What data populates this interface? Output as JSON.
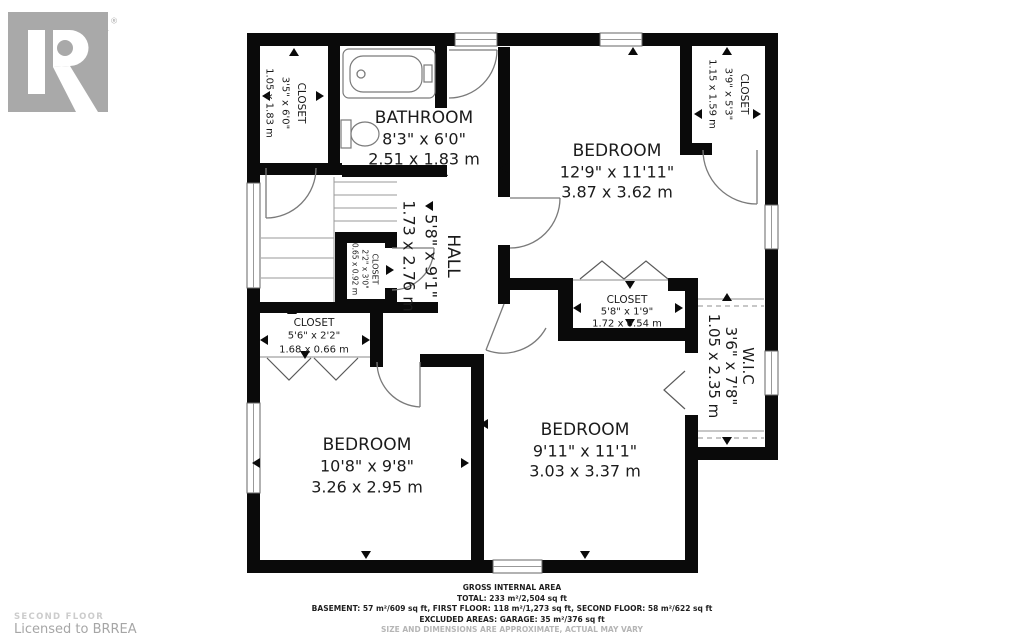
{
  "branding": {
    "logo_letter": "R",
    "logo_text": "REALTOR",
    "registered_mark": "®"
  },
  "credits": {
    "floor_label": "SECOND FLOOR",
    "license": "Licensed to BRREA"
  },
  "rooms": {
    "bathroom": {
      "name": "BATHROOM",
      "imperial": "8'3\" x 6'0\"",
      "metric": "2.51 x 1.83 m"
    },
    "bedroom_tr": {
      "name": "BEDROOM",
      "imperial": "12'9\" x 11'11\"",
      "metric": "3.87 x 3.62 m"
    },
    "hall": {
      "name": "HALL",
      "imperial": "5'8\" x 9'1\"",
      "metric": "1.73 x 2.76 m"
    },
    "bedroom_bl": {
      "name": "BEDROOM",
      "imperial": "10'8\" x 9'8\"",
      "metric": "3.26 x 2.95 m"
    },
    "bedroom_bm": {
      "name": "BEDROOM",
      "imperial": "9'11\" x 11'1\"",
      "metric": "3.03 x 3.37 m"
    },
    "wic": {
      "name": "W.I.C",
      "imperial": "3'6\" x 7'8\"",
      "metric": "1.05 x 2.35 m"
    },
    "closet_tl": {
      "name": "CLOSET",
      "imperial": "3'5\" x 6'0\"",
      "metric": "1.05 x 1.83 m"
    },
    "closet_tr": {
      "name": "CLOSET",
      "imperial": "3'9\" x 5'3\"",
      "metric": "1.15 x 1.59 m"
    },
    "closet_hall": {
      "name": "CLOSET",
      "imperial": "2'2\" x 3'0\"",
      "metric": "0.65 x 0.92 m"
    },
    "closet_bl": {
      "name": "CLOSET",
      "imperial": "5'6\" x 2'2\"",
      "metric": "1.68 x 0.66 m"
    },
    "closet_bm": {
      "name": "CLOSET",
      "imperial": "5'8\" x 1'9\"",
      "metric": "1.72 x 0.54 m"
    }
  },
  "footer": {
    "title": "GROSS INTERNAL AREA",
    "total": "TOTAL: 233 m²/2,504 sq ft",
    "breakdown": "BASEMENT: 57 m²/609 sq ft, FIRST FLOOR: 118 m²/1,273 sq ft, SECOND FLOOR: 58 m²/622 sq ft",
    "excluded": "EXCLUDED AREAS: GARAGE: 35 m²/376 sq ft",
    "disclaimer": "SIZE AND DIMENSIONS ARE APPROXIMATE, ACTUAL MAY VARY"
  },
  "colors": {
    "wall": "#0a0a0a",
    "fixture_line": "#7a7a7a",
    "logo_gray": "#a9a9a9"
  }
}
